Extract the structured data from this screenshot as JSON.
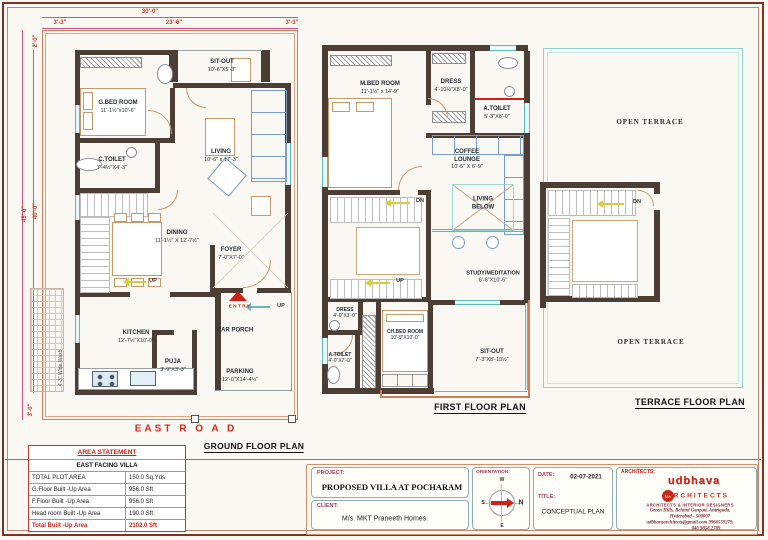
{
  "dims": {
    "top_total": "30'-0\"",
    "top_left": "3'-3\"",
    "top_mid": "23'-6\"",
    "top_right": "3'-3\"",
    "left_offset": "2'-0\"",
    "left_total": "45'-0\"",
    "left_inner": "40'-0\"",
    "left_bottom": "3'-0\"",
    "wash": "4'-3\" Wide Wash"
  },
  "ground": {
    "title": "GROUND FLOOR PLAN",
    "road": "EAST  R O A D",
    "sitout_name": "SIT-OUT",
    "sitout_dims": "10'-6\"X5'-3\"",
    "gbed_name": "G.BED ROOM",
    "gbed_dims": "11'-1½\"x10'-6\"",
    "living_name": "LIVING",
    "living_dims": "10'-6\" x 17'-3\"",
    "ctoilet_name": "C.TOILET",
    "ctoilet_dims": "7'-4½\"X4'-3\"",
    "dining_name": "DINING",
    "dining_dims": "11'-1½\" X 12'-7½\"",
    "foyer_name": "FOYER",
    "foyer_dims": "7'-0\"X7'-0\"",
    "kitchen_name": "KITCHEN",
    "kitchen_dims": "12'-7½\"X10'-0\"",
    "puja_name": "PUJA",
    "puja_dims": "3'-9\"X3'-3\"",
    "carporch_name": "CAR PORCH",
    "parking_name": "PARKING",
    "parking_dims": "12'-0\"X14'-4½\"",
    "up1": "UP",
    "up2": "UP",
    "entry": "ENTRY"
  },
  "first": {
    "title": "FIRST FLOOR PLAN",
    "mbed_name": "M.BED ROOM",
    "mbed_dims": "11'-1½\" x 14'-9\"",
    "dress1_name": "DRESS",
    "dress1_dims": "4'-10½\"X8'-0\"",
    "atoilet1_name": "A.TOILET",
    "atoilet1_dims": "5'-3\"X8'-0\"",
    "coffee_name1": "COFFEE",
    "coffee_name2": "LOUNGE",
    "coffee_dims": "10'-6\" X 6'-9\"",
    "livingbelow1": "LIVING",
    "livingbelow2": "BELOW",
    "study_name": "STUDY/MEDITATION",
    "study_dims": "6'-6\"X10'-6\"",
    "dress2_name": "DRESS",
    "dress2_dims": "4'-0\"X3'-0\"",
    "atoilet2_name": "A.TOILET",
    "atoilet2_dims": "4'-0\"X7'-0\"",
    "chbed_name": "CH.BED ROOM",
    "chbed_dims": "10'-9\"X10'-0\"",
    "sitout_name": "SIT-OUT",
    "sitout_dims": "7'-3\"X8'-10½\"",
    "dn": "DN",
    "up": "UP"
  },
  "terrace": {
    "title": "TERRACE FLOOR PLAN",
    "open_top": "OPEN TERRACE",
    "open_bottom": "OPEN TERRACE",
    "dn": "DN"
  },
  "area_table": {
    "header": "AREA STATEMENT",
    "subheader": "EAST FACING VILLA",
    "rows": [
      {
        "label": "TOTAL PLOT AREA",
        "value": "150.0 Sq.Yds"
      },
      {
        "label": "G.Floor Built -Up Area",
        "value": "956.0 Sft"
      },
      {
        "label": "F.Floor Built -Up Area",
        "value": "956.0 Sft"
      },
      {
        "label": "Head room Built -Up Area",
        "value": "190.0 Sft"
      },
      {
        "label": "Total Built -Up Area",
        "value": "2102.0 Sft"
      }
    ]
  },
  "titleblock": {
    "project_label": "PROJECT:",
    "project": "PROPOSED VILLA AT POCHARAM",
    "client_label": "CLIENT:",
    "client": "M/s. MKT Praneeth Homes.",
    "orientation_label": "ORIENTATION:",
    "compass": {
      "n": "N",
      "s": "S",
      "e": "E",
      "w": "W"
    },
    "date_label": "DATE:",
    "date": "02-07-2021",
    "title_label": "TITLE:",
    "title": "CONCEPTUAL PLAN",
    "architects_label": "ARCHITECTS:",
    "logo_top": "udbhava",
    "logo_bottom": "ARCHITECTS",
    "logo_badge": "UA",
    "tagline": "ARCHITECTS & INTERIOR DESIGNERS",
    "address1": "Green Hills, Behind Ganpati, Antriguda,",
    "address2": "Hyderabad - 500007",
    "contact1": "udbhavaarchitects@gmail.com 9966559279,",
    "contact2": "040 9858 2789"
  }
}
